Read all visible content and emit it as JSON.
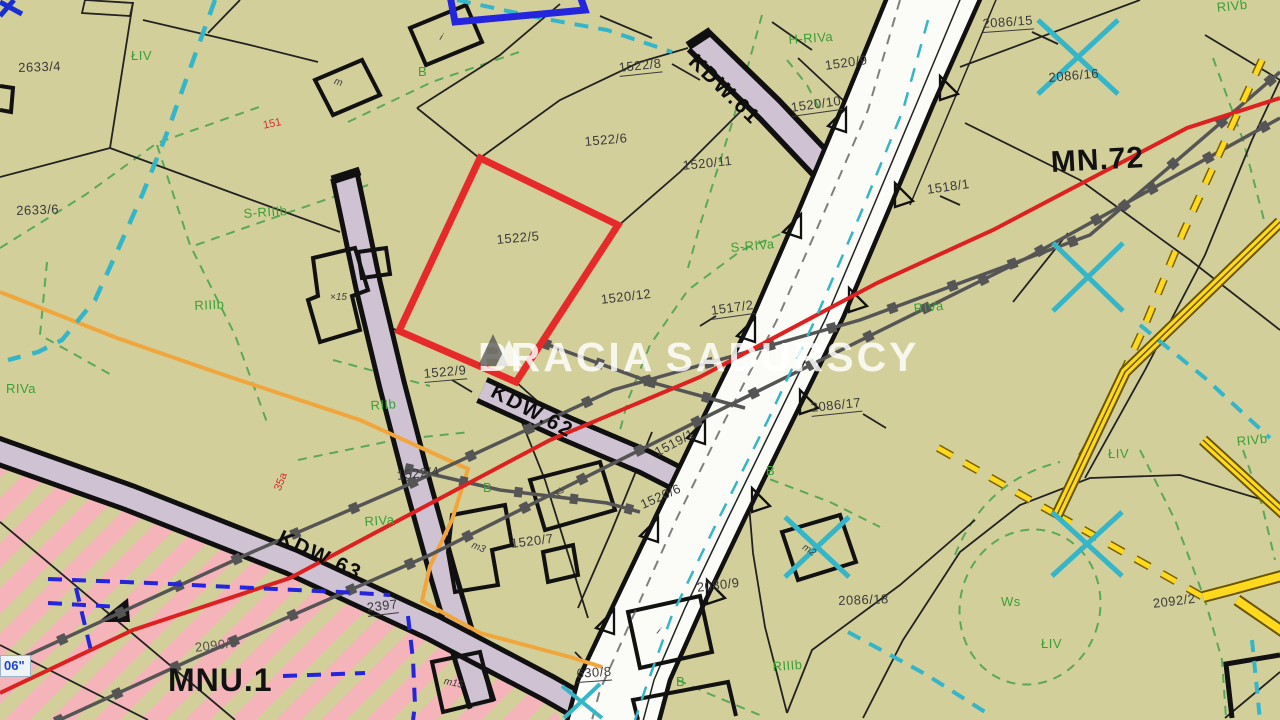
{
  "watermark": {
    "left": "BRACIA",
    "right": "SADURSCY"
  },
  "zone_labels": [
    {
      "text": "MN.72"
    },
    {
      "text": "MNU.1"
    }
  ],
  "road_labels": [
    {
      "text": "KDW.61"
    },
    {
      "text": "KDW.62"
    },
    {
      "text": "KDW.63"
    }
  ],
  "parcel_labels": [
    {
      "text": "2633/4"
    },
    {
      "text": "2633/6"
    },
    {
      "text": "1522/8"
    },
    {
      "text": "1520/9"
    },
    {
      "text": "1520/10"
    },
    {
      "text": "1520/11"
    },
    {
      "text": "1522/6"
    },
    {
      "text": "2086/15"
    },
    {
      "text": "2086/16"
    },
    {
      "text": "1518/1"
    },
    {
      "text": "1522/5"
    },
    {
      "text": "1520/12"
    },
    {
      "text": "1517/2"
    },
    {
      "text": "1522/9"
    },
    {
      "text": "2086/17"
    },
    {
      "text": "1519/1"
    },
    {
      "text": "1522/4"
    },
    {
      "text": "1520/7"
    },
    {
      "text": "1520/6"
    },
    {
      "text": "2080/9"
    },
    {
      "text": "2086/18"
    },
    {
      "text": "2092/2"
    },
    {
      "text": "2090/8"
    },
    {
      "text": "2397"
    },
    {
      "text": "630/8"
    }
  ],
  "landuse_labels": [
    {
      "text": "ŁIV"
    },
    {
      "text": "B"
    },
    {
      "text": "S-RIIIb"
    },
    {
      "text": "H-RIVa"
    },
    {
      "text": "RIVb"
    },
    {
      "text": "S-RIVa"
    },
    {
      "text": "RIVa"
    },
    {
      "text": "RIIIb"
    },
    {
      "text": "RIVa"
    },
    {
      "text": "RIIb"
    },
    {
      "text": "RIVa"
    },
    {
      "text": "B"
    },
    {
      "text": "B"
    },
    {
      "text": "B"
    },
    {
      "text": "RIIIb"
    },
    {
      "text": "Ws"
    },
    {
      "text": "ŁIV"
    },
    {
      "text": "ŁIV"
    },
    {
      "text": "RIVb"
    }
  ],
  "control_labels": [
    {
      "text": "151"
    },
    {
      "text": "35a"
    }
  ],
  "building_labels": [
    {
      "text": "m"
    },
    {
      "text": "i"
    },
    {
      "text": "×15"
    },
    {
      "text": "m3"
    },
    {
      "text": "i2"
    },
    {
      "text": "m15"
    },
    {
      "text": "i"
    },
    {
      "text": "m2"
    }
  ],
  "utility_label": {
    "text": "06\""
  },
  "colors": {
    "background": "#d3cf9b",
    "parcel_line": "#1a1a1a",
    "landuse_green": "#3aa035",
    "road_lavender": "#cfc2d2",
    "highlight_red": "#e62222",
    "water_cyan": "#35b5c8",
    "utility_gray": "#555555",
    "gas_yellow": "#f2ca00",
    "pipe_orange": "#f0a63c",
    "zone_pink": "#f5b3ba",
    "survey_blue": "#2525dd"
  }
}
